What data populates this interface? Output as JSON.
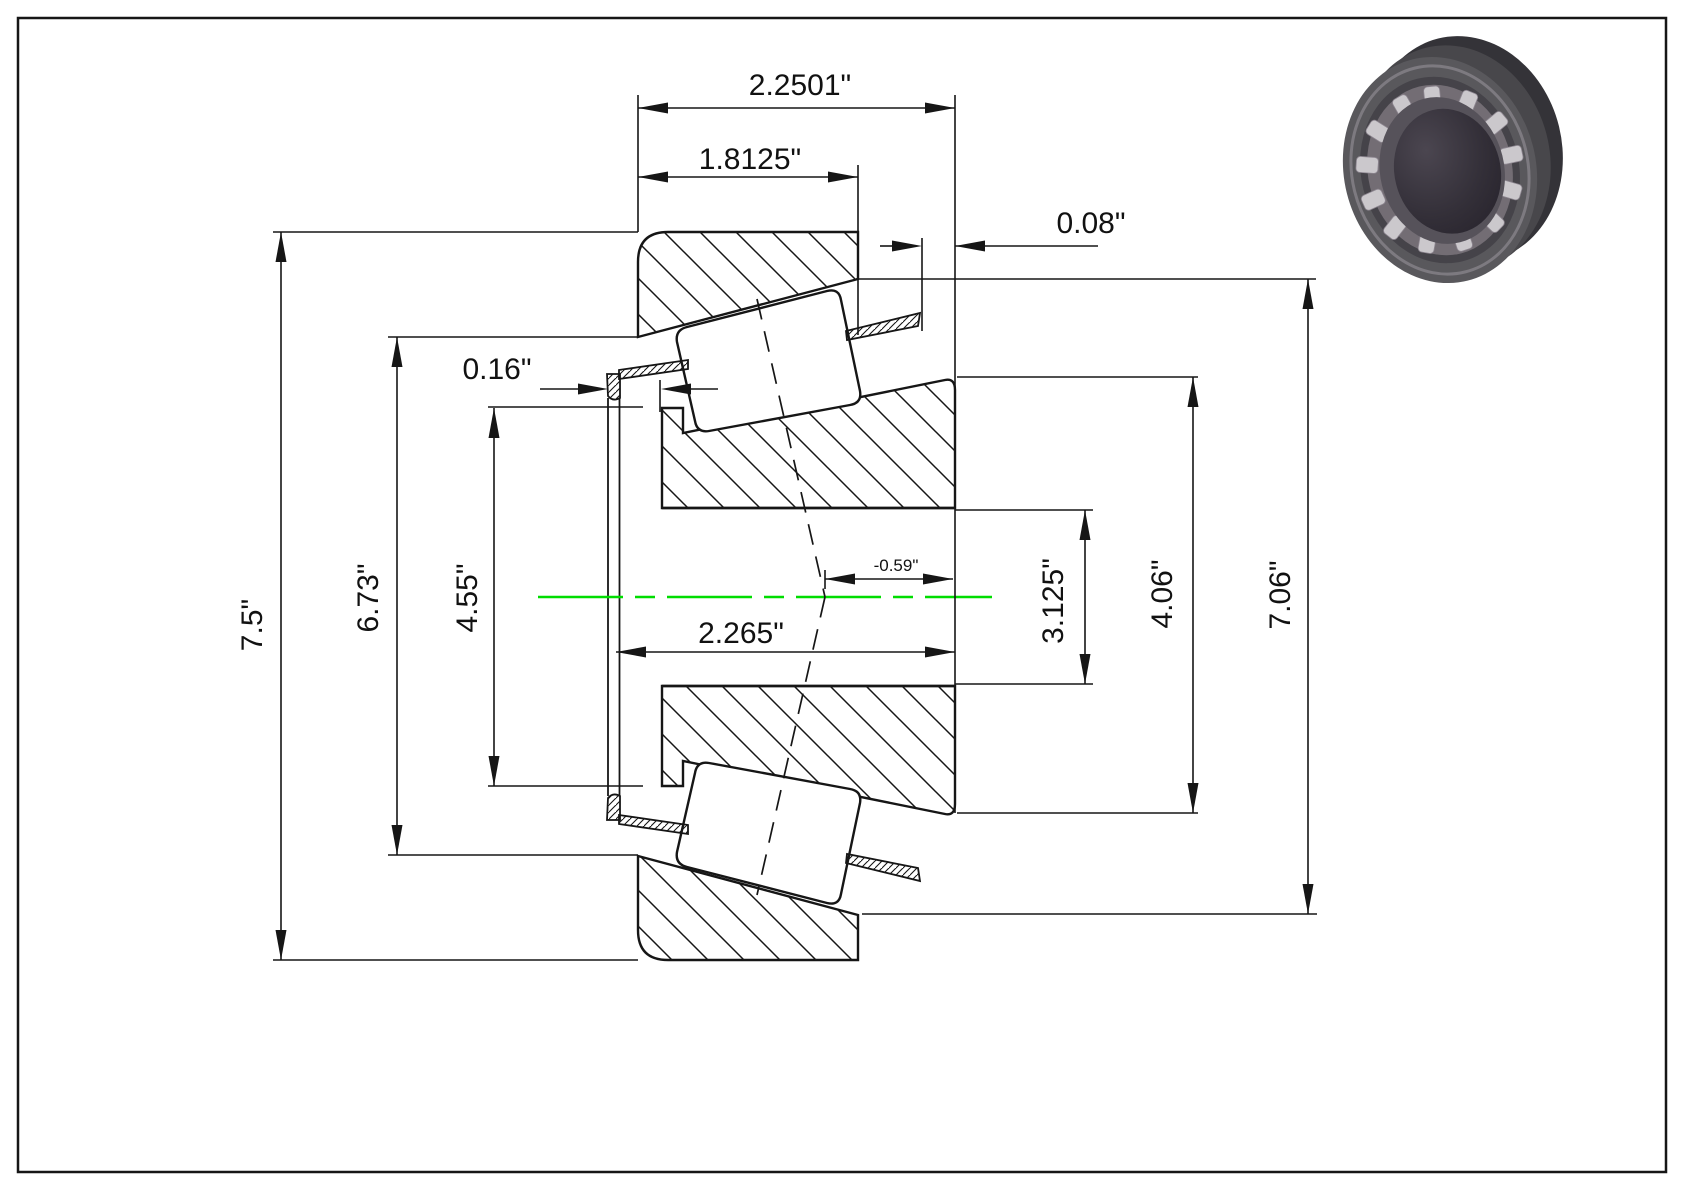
{
  "drawing": {
    "title": "tapered-roller-bearing-cross-section",
    "colors": {
      "line": "#161616",
      "centerline_green": "#00dd00",
      "bearing_face_gray": "#59585c",
      "bearing_side_gray": "#343338",
      "roller_gray": "#cbc8cc",
      "bore_dark": "#2e2a31"
    },
    "dims": [
      {
        "id": "overall-width-top",
        "label": "2.2501\""
      },
      {
        "id": "cup-width",
        "label": "1.8125\""
      },
      {
        "id": "standout-back",
        "label": "0.08\""
      },
      {
        "id": "standout-front",
        "label": "0.16\""
      },
      {
        "id": "effective-center",
        "label": "-0.59\""
      },
      {
        "id": "cone-width",
        "label": "2.265\""
      },
      {
        "id": "cup-outer-diameter",
        "label": "7.5\""
      },
      {
        "id": "cup-shoulder-diameter",
        "label": "6.73\""
      },
      {
        "id": "cone-front-diameter",
        "label": "4.55\""
      },
      {
        "id": "cone-rib-diameter",
        "label": "3.125\""
      },
      {
        "id": "cone-back-diameter",
        "label": "4.06\""
      },
      {
        "id": "cup-face-diameter",
        "label": "7.06\""
      }
    ]
  }
}
